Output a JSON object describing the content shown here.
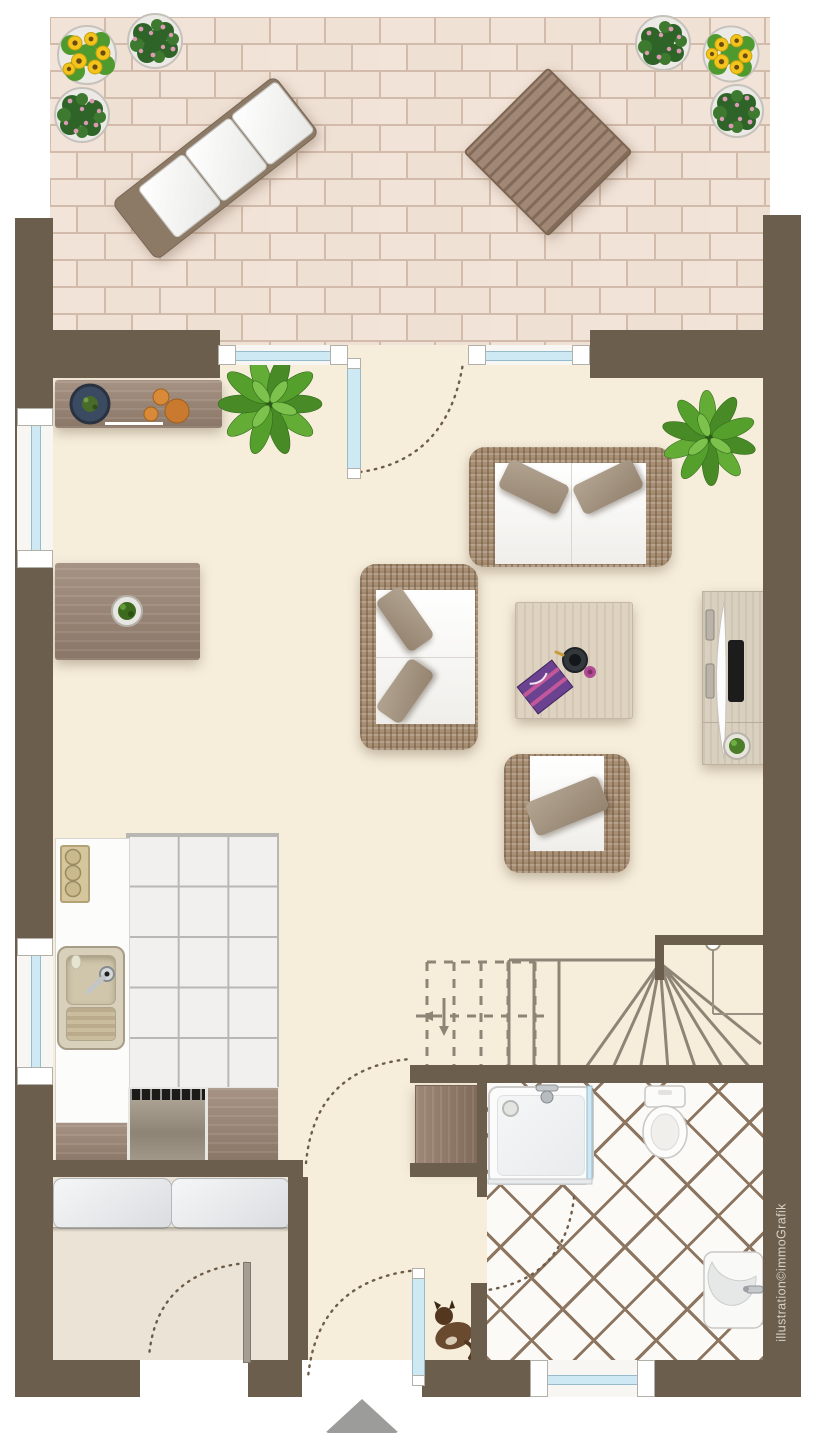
{
  "credit": {
    "label": "illustration©immoGrafik"
  },
  "colors": {
    "wall": "#6b5e4c",
    "floor": "#f6eedb",
    "entry-floor": "#ebe4d6",
    "kitchen-tile": "#f1f0ee",
    "kitchen-grout": "#b9b7b3",
    "bath-tile": "#fbfaf7",
    "bath-grout": "#8d7560",
    "terrace-paver": "#f2e3d8",
    "terrace-grout": "#d2bbaa",
    "glass": "#cfe9f4",
    "glass-border": "#96bccc",
    "stair-line": "#8e8577",
    "dash": "#6e5c49",
    "wood-dark": "#5b4734",
    "wood-mid": "#97816f",
    "wood-light": "#ddd2c1",
    "wicker": "#a98f73",
    "cushion": "#fafaf8",
    "pillow": "#a79783",
    "counter": "#fcfcfb",
    "credit-text": "#d8d2c6",
    "arrow": "#9c9c9a",
    "sunflower": "#f3c41c"
  },
  "floor_plan": {
    "rooms": [
      "terrace",
      "living-dining-room",
      "kitchen",
      "hallway",
      "staircase",
      "bathroom",
      "storage-entry-room"
    ],
    "furniture": {
      "terrace": [
        "sun-lounger",
        "patio-dining-table",
        "patio-chair",
        "patio-chair",
        "patio-chair",
        "patio-chair",
        "flower-pot-sunflowers",
        "flower-pot-geraniums",
        "flower-pot-geraniums",
        "flower-pot-geraniums",
        "flower-pot-sunflowers",
        "flower-pot-geraniums"
      ],
      "living_dining": [
        "sideboard-with-bowl-and-fruit",
        "potted-plant",
        "potted-plant",
        "dining-table-with-plant",
        "dining-chair",
        "dining-chair",
        "dining-chair",
        "dining-chair",
        "dining-chair",
        "sofa-two-seat",
        "sofa-two-seat",
        "armchair",
        "coffee-table-with-tray-and-book",
        "tv-sideboard-with-tv"
      ],
      "kitchen": [
        "kitchen-counter",
        "cooktop",
        "sink-with-drainboard",
        "dishwasher",
        "base-cabinet",
        "base-cabinet"
      ],
      "hallway": [
        "cabinet",
        "cat"
      ],
      "bathroom": [
        "shower",
        "toilet",
        "washbasin"
      ],
      "storage_entry": [
        "bench-with-cushions"
      ],
      "staircase": [
        "winder-stairs",
        "handrail-with-newel-post"
      ]
    },
    "symbols": [
      "door-swing-arc",
      "entrance-arrow",
      "window",
      "door-leaf"
    ]
  }
}
